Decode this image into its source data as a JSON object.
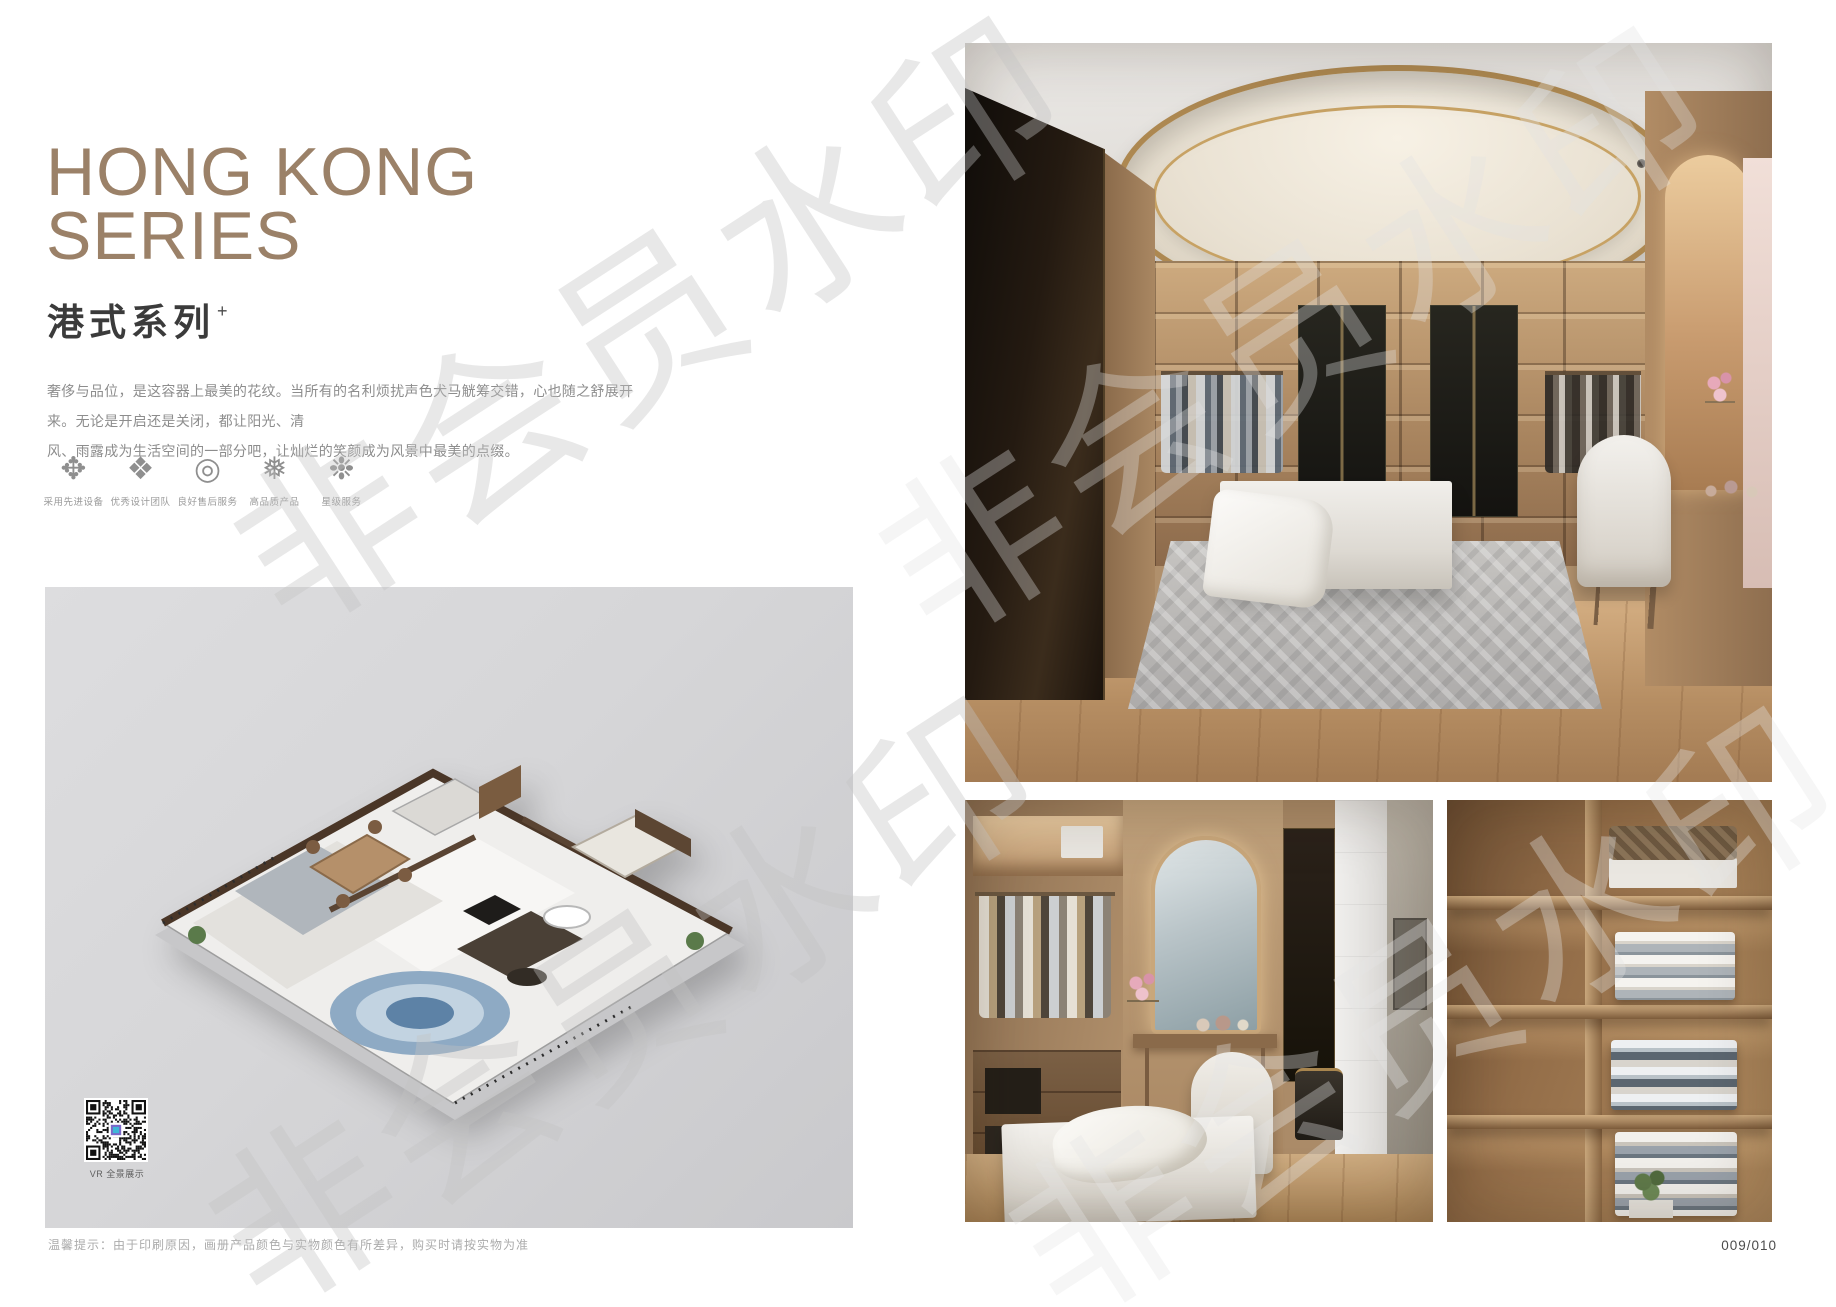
{
  "watermark": {
    "text": "非会员水印"
  },
  "header": {
    "title_line1": "HONG KONG",
    "title_line2": "SERIES",
    "subtitle": "港式系列",
    "subtitle_mark": "+",
    "description_line1": "奢侈与品位，是这容器上最美的花纹。当所有的名利烦扰声色犬马觥筹交错，心也随之舒展开来。无论是开启还是关闭，都让阳光、清",
    "description_line2": "风、雨露成为生活空间的一部分吧，让灿烂的笑颜成为风景中最美的点缀。"
  },
  "features": {
    "items": [
      {
        "icon": "ornament-flower-icon",
        "glyph": "✥",
        "label": "采用先进设备"
      },
      {
        "icon": "ornament-diamond-icon",
        "glyph": "❖",
        "label": "优秀设计团队"
      },
      {
        "icon": "ring-icon",
        "glyph": "◎",
        "label": "良好售后服务"
      },
      {
        "icon": "snowflake-icon",
        "glyph": "❅",
        "label": "高品质产品"
      },
      {
        "icon": "star-ornament-icon",
        "glyph": "❉",
        "label": "星级服务"
      }
    ]
  },
  "captions": {
    "vr": "VR 全景展示"
  },
  "footer": {
    "note": "温馨提示：由于印刷原因，画册产品颜色与实物颜色有所差异，购买时请按实物为准",
    "page_number": "009/010"
  },
  "colors": {
    "accent": "#9b8168",
    "panel_bg": "#d8d8da"
  }
}
